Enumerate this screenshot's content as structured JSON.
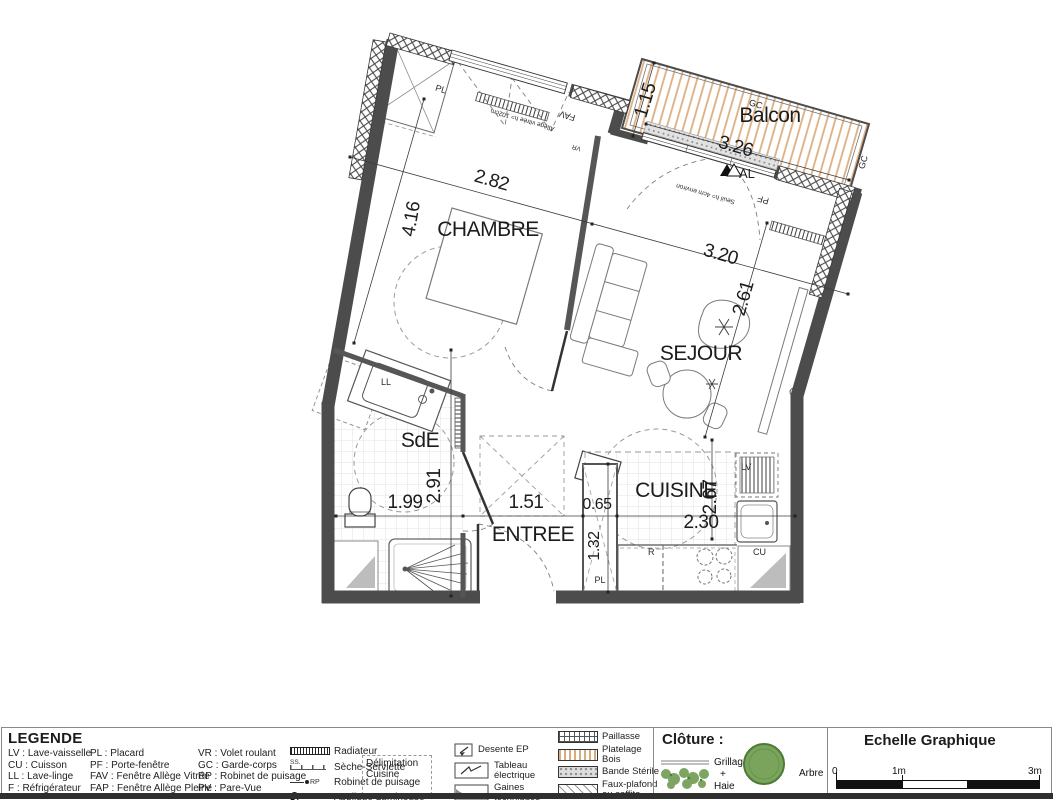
{
  "plan": {
    "rooms": {
      "chambre": "CHAMBRE",
      "sejour": "SEJOUR",
      "cuisine": "CUISINE",
      "entree": "ENTREE",
      "sde": "SdE",
      "balcon": "Balcon"
    },
    "dims": {
      "chambre_w": "2.82",
      "chambre_h": "4.16",
      "sejour_w": "3.20",
      "sejour_h": "2.61",
      "balcon_d": "1.15",
      "balcon_w": "3.26",
      "sde_w": "1.99",
      "sde_h": "2.91",
      "entree_w": "1.51",
      "closet_w": "0.65",
      "closet_h": "1.32",
      "cuisine_w": "2.30",
      "cuisine_h": "2.67"
    },
    "tags": {
      "pl_top": "PL",
      "pl_entree": "PL",
      "fav": "FAV",
      "vr": "VR",
      "pf": "PF",
      "gc_balcon": "GC",
      "gc_right": "GC",
      "al": "AL",
      "ll": "LL",
      "lv": "LV",
      "r": "R",
      "cu": "CU"
    },
    "notes": {
      "allege": "Allège vitrée h= 102cm",
      "seuil": "Seuil h= 4cm environ"
    }
  },
  "legend": {
    "title": "LEGENDE",
    "abbr_col1": [
      "LV : Lave-vaisselle",
      "CU : Cuisson",
      "LL : Lave-linge",
      "F : Réfrigérateur"
    ],
    "abbr_col2": [
      "PL : Placard",
      "PF : Porte-fenêtre",
      "FAV : Fenêtre Allège Vitrée",
      "FAP : Fenêtre Allège Pleine"
    ],
    "abbr_col3": [
      "VR : Volet roulant",
      "GC : Garde-corps",
      "RP : Robinet de puisage",
      "PV : Pare-Vue"
    ],
    "symbols": {
      "ss_tag": "SS.",
      "rp_tag": "RP",
      "al_tag": "AL",
      "radiateur": "Radiateur",
      "seche": "Sèche-Serviette",
      "robinet": "Robinet de puisage",
      "applique": "Applique Lumineuse"
    },
    "delimitation": "Délimitation Cuisine",
    "icons": {
      "desente": "Desente EP",
      "tableau": "Tableau électrique",
      "gaines": "Gaines techniques"
    },
    "patterns": {
      "paillasse": "Paillasse",
      "platelage": "Platelage Bois",
      "bande": "Bande Stérile",
      "faux": "Faux-plafond ou soffite"
    }
  },
  "cloture": {
    "title": "Clôture :",
    "grillage": "Grillage",
    "plus": "+",
    "haie": "Haie",
    "arbre": "Arbre"
  },
  "echelle": {
    "title": "Echelle Graphique",
    "t0": "0",
    "t1": "1m",
    "t3": "3m"
  },
  "colors": {
    "wall": "#4c4c4c",
    "wood": "#dcaf82",
    "green": "#6d9c50"
  }
}
